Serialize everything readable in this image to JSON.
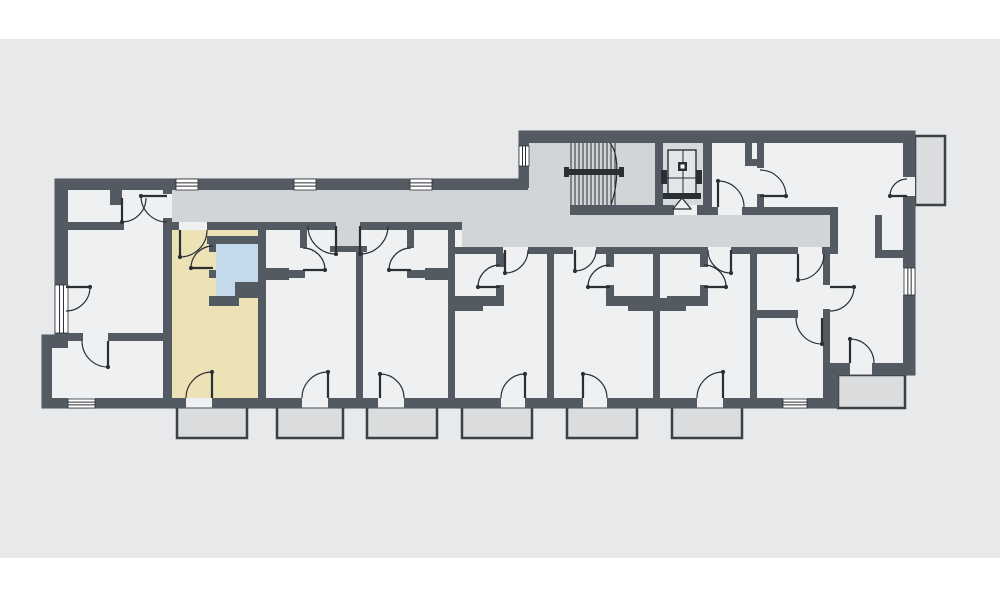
{
  "colors": {
    "page": "#ffffff",
    "canvas": "#e7e9ea",
    "room": "#eef0f1",
    "corridor": "#d2d5d7",
    "shaft": "#d7dadc",
    "wall": "#535a62",
    "outline_stroke": "#4a5158",
    "line": "#2a2f34",
    "highlight": "#ece2b6",
    "bathroom": "#c5d9ec",
    "balcony_fill": "#dadcde",
    "balcony_stroke": "#3a4046",
    "window_fill": "#ffffff",
    "car_fill": "#e3e5e7"
  },
  "canvas_band": {
    "x": 0,
    "y": 39,
    "w": 1000,
    "h": 519
  },
  "plan": {
    "outline": "M 55,179 L 519,179 L 519,131 L 915,131 L 915,375 L 838,375 L 838,408 L 42,408 L 42,335 L 55,335 Z",
    "corridor": "M 172,190 L 528,190 L 528,215 L 830,215 L 830,247 L 462,247 L 462,222 L 360,222 L 360,246 L 336,246 L 336,222 L 172,222 Z",
    "stairwell": [
      528,
      142,
      127,
      73
    ],
    "elevator_shaft": [
      663,
      142,
      40,
      63
    ],
    "highlighted_unit": [
      172,
      230,
      86,
      168
    ],
    "highlighted_bathroom": "M 216,244 L 258,244 L 258,282 L 237,282 L 237,296 L 216,296 Z",
    "walls": [
      [
        55,
        179,
        121,
        11
      ],
      [
        198,
        179,
        96,
        11
      ],
      [
        316,
        179,
        94,
        11
      ],
      [
        432,
        179,
        96,
        11
      ],
      [
        519,
        131,
        396,
        12
      ],
      [
        519,
        131,
        10,
        15
      ],
      [
        519,
        166,
        10,
        22
      ],
      [
        903,
        131,
        12,
        46
      ],
      [
        903,
        196,
        12,
        72
      ],
      [
        903,
        295,
        12,
        80
      ],
      [
        55,
        188,
        13,
        97
      ],
      [
        55,
        333,
        13,
        5
      ],
      [
        42,
        335,
        26,
        13
      ],
      [
        42,
        335,
        10,
        73
      ],
      [
        42,
        398,
        26,
        10
      ],
      [
        95,
        398,
        91,
        10
      ],
      [
        212,
        398,
        90,
        10
      ],
      [
        328,
        398,
        50,
        10
      ],
      [
        404,
        398,
        97,
        10
      ],
      [
        525,
        398,
        58,
        10
      ],
      [
        607,
        398,
        90,
        10
      ],
      [
        723,
        398,
        60,
        10
      ],
      [
        807,
        398,
        31,
        10
      ],
      [
        830,
        363,
        20,
        12
      ],
      [
        872,
        363,
        43,
        12
      ],
      [
        830,
        375,
        8,
        33
      ],
      [
        163,
        188,
        9,
        6
      ],
      [
        163,
        218,
        9,
        180
      ],
      [
        163,
        222,
        16,
        8
      ],
      [
        207,
        222,
        129,
        8
      ],
      [
        360,
        222,
        102,
        8
      ],
      [
        455,
        247,
        48,
        7
      ],
      [
        528,
        247,
        45,
        7
      ],
      [
        596,
        247,
        112,
        7
      ],
      [
        731,
        247,
        67,
        7
      ],
      [
        822,
        247,
        16,
        7
      ],
      [
        570,
        205,
        107,
        10
      ],
      [
        697,
        205,
        15,
        10
      ],
      [
        712,
        207,
        6,
        8
      ],
      [
        742,
        207,
        88,
        8
      ],
      [
        830,
        207,
        8,
        47
      ],
      [
        655,
        142,
        8,
        73
      ],
      [
        703,
        142,
        9,
        73
      ],
      [
        757,
        142,
        7,
        26
      ],
      [
        757,
        194,
        7,
        21
      ],
      [
        745,
        142,
        7,
        24
      ],
      [
        745,
        159,
        17,
        7
      ],
      [
        875,
        215,
        7,
        35
      ],
      [
        875,
        250,
        30,
        8
      ],
      [
        823,
        254,
        7,
        31
      ],
      [
        823,
        309,
        7,
        89
      ],
      [
        755,
        310,
        43,
        8
      ],
      [
        258,
        230,
        8,
        168
      ],
      [
        356,
        246,
        7,
        152
      ],
      [
        448,
        222,
        7,
        176
      ],
      [
        547,
        247,
        7,
        151
      ],
      [
        653,
        247,
        7,
        151
      ],
      [
        750,
        247,
        7,
        151
      ],
      [
        330,
        246,
        37,
        6
      ],
      [
        207,
        236,
        51,
        8
      ],
      [
        209,
        244,
        7,
        8
      ],
      [
        209,
        270,
        7,
        8
      ],
      [
        209,
        296,
        30,
        10
      ],
      [
        235,
        282,
        31,
        16
      ],
      [
        259,
        268,
        30,
        12
      ],
      [
        287,
        270,
        18,
        8
      ],
      [
        300,
        226,
        7,
        22
      ],
      [
        425,
        268,
        30,
        12
      ],
      [
        407,
        270,
        18,
        8
      ],
      [
        407,
        226,
        7,
        22
      ],
      [
        496,
        253,
        8,
        14
      ],
      [
        496,
        285,
        8,
        13
      ],
      [
        455,
        296,
        49,
        10
      ],
      [
        455,
        298,
        28,
        13
      ],
      [
        606,
        253,
        8,
        14
      ],
      [
        606,
        285,
        8,
        13
      ],
      [
        606,
        296,
        47,
        10
      ],
      [
        628,
        298,
        58,
        13
      ],
      [
        700,
        253,
        8,
        14
      ],
      [
        700,
        285,
        8,
        13
      ],
      [
        667,
        296,
        41,
        10
      ],
      [
        110,
        188,
        12,
        17
      ],
      [
        68,
        222,
        56,
        8
      ],
      [
        60,
        333,
        23,
        8
      ],
      [
        108,
        333,
        55,
        8
      ]
    ],
    "room_patches": [
      [
        903,
        177,
        12,
        19
      ],
      [
        674,
        205,
        23,
        10
      ]
    ],
    "windows": [
      {
        "r": [
          176,
          179,
          22,
          11
        ],
        "o": "h"
      },
      {
        "r": [
          294,
          179,
          22,
          11
        ],
        "o": "h"
      },
      {
        "r": [
          410,
          179,
          22,
          11
        ],
        "o": "h"
      },
      {
        "r": [
          519,
          146,
          10,
          20
        ],
        "o": "v"
      },
      {
        "r": [
          55,
          285,
          13,
          48
        ],
        "o": "v"
      },
      {
        "r": [
          68,
          399,
          27,
          9
        ],
        "o": "h"
      },
      {
        "r": [
          783,
          399,
          24,
          9
        ],
        "o": "h"
      },
      {
        "r": [
          904,
          268,
          11,
          27
        ],
        "o": "v"
      }
    ],
    "doors": [
      {
        "a": "M 141,196 A 26 26 0 0 0 167,222",
        "l": [
          167,
          196,
          141,
          196
        ]
      },
      {
        "a": "M 122,222 A 24 24 0 0 0 146,198",
        "l": [
          122,
          198,
          122,
          222
        ]
      },
      {
        "a": "M 82,341 A 26 26 0 0 0 108,367",
        "l": [
          108,
          341,
          108,
          367
        ]
      },
      {
        "a": "M 90,287 A 24 24 0 0 1 66,311",
        "l": [
          66,
          287,
          90,
          287
        ]
      },
      {
        "a": "M 180,257 A 27 27 0 0 0 207,230",
        "l": [
          180,
          230,
          180,
          257
        ]
      },
      {
        "a": "M 191,268 A 22 22 0 0 1 213,246",
        "l": [
          213,
          268,
          191,
          268
        ]
      },
      {
        "a": "M 186,398 A 26 26 0 0 1 212,372",
        "l": [
          212,
          398,
          212,
          372
        ]
      },
      {
        "a": "M 308,226 A 28 28 0 0 0 336,254",
        "l": [
          336,
          226,
          336,
          254
        ]
      },
      {
        "a": "M 325,270 A 22 22 0 0 0 303,248",
        "l": [
          303,
          270,
          325,
          270
        ]
      },
      {
        "a": "M 302,398 A 26 26 0 0 1 328,372",
        "l": [
          328,
          398,
          328,
          372
        ]
      },
      {
        "a": "M 360,254 A 28 28 0 0 0 388,226",
        "l": [
          360,
          226,
          360,
          254
        ]
      },
      {
        "a": "M 389,270 A 22 22 0 0 1 411,248",
        "l": [
          411,
          270,
          389,
          270
        ]
      },
      {
        "a": "M 404,398 A 24 24 0 0 0 380,374",
        "l": [
          380,
          398,
          380,
          374
        ]
      },
      {
        "a": "M 528,250 A 23 23 0 0 1 505,273",
        "l": [
          505,
          250,
          505,
          273
        ]
      },
      {
        "a": "M 478,287 A 22 22 0 0 1 500,265",
        "l": [
          500,
          287,
          478,
          287
        ]
      },
      {
        "a": "M 501,398 A 24 24 0 0 1 525,374",
        "l": [
          525,
          398,
          525,
          374
        ]
      },
      {
        "a": "M 596,250 A 21 21 0 0 1 575,271",
        "l": [
          575,
          250,
          575,
          271
        ]
      },
      {
        "a": "M 588,287 A 22 22 0 0 1 610,265",
        "l": [
          610,
          287,
          588,
          287
        ]
      },
      {
        "a": "M 607,398 A 24 24 0 0 0 583,374",
        "l": [
          583,
          398,
          583,
          374
        ]
      },
      {
        "a": "M 708,250 A 23 23 0 0 0 731,273",
        "l": [
          731,
          250,
          731,
          273
        ]
      },
      {
        "a": "M 726,287 A 22 22 0 0 0 704,265",
        "l": [
          704,
          287,
          726,
          287
        ]
      },
      {
        "a": "M 697,398 A 26 26 0 0 1 723,372",
        "l": [
          723,
          398,
          723,
          372
        ]
      },
      {
        "a": "M 718,181 A 26 26 0 0 1 744,207",
        "l": [
          718,
          207,
          718,
          181
        ]
      },
      {
        "a": "M 786,196 A 26 26 0 0 0 760,170",
        "l": [
          760,
          196,
          786,
          196
        ]
      },
      {
        "a": "M 890,196 A 17 17 0 0 1 907,179",
        "l": [
          907,
          196,
          890,
          196
        ]
      },
      {
        "a": "M 798,280 A 26 26 0 0 0 824,254",
        "l": [
          798,
          254,
          798,
          280
        ]
      },
      {
        "a": "M 796,318 A 26 26 0 0 0 822,344",
        "l": [
          822,
          318,
          822,
          344
        ]
      },
      {
        "a": "M 854,287 A 24 24 0 0 1 830,311",
        "l": [
          830,
          287,
          854,
          287
        ]
      },
      {
        "a": "M 874,363 A 24 24 0 0 0 850,339",
        "l": [
          850,
          363,
          850,
          339
        ]
      }
    ],
    "stairs": {
      "treads": {
        "x0": 571,
        "n": 12,
        "dx": 4,
        "y0": 143,
        "y1": 205
      },
      "rail": [
        566,
        169,
        56,
        6
      ],
      "rail_caps": [
        [
          564,
          167,
          5,
          10
        ],
        [
          619,
          167,
          5,
          10
        ]
      ],
      "curve": "M 610,143 C 620,155 618,185 611,205"
    },
    "elevator": {
      "car": [
        668,
        150,
        28,
        46
      ],
      "cross_h": [
        664,
        178,
        700,
        178
      ],
      "cross_v": [
        683,
        150,
        683,
        196
      ],
      "brackets": [
        [
          661,
          170,
          6,
          14
        ],
        [
          696,
          170,
          6,
          14
        ]
      ],
      "square": [
        678,
        162,
        9,
        9
      ],
      "square_inner": [
        680.5,
        164.5,
        4,
        4
      ],
      "sill": [
        663,
        193,
        38,
        6
      ],
      "triangle": "M 682,198 L 673,209 L 691,209 Z"
    },
    "balconies": [
      [
        177,
        406,
        70,
        32
      ],
      [
        277,
        406,
        66,
        32
      ],
      [
        367,
        406,
        70,
        32
      ],
      [
        462,
        406,
        70,
        32
      ],
      [
        567,
        406,
        70,
        32
      ],
      [
        672,
        406,
        70,
        32
      ],
      [
        838,
        375,
        67,
        33
      ],
      [
        915,
        136,
        30,
        69
      ]
    ]
  }
}
